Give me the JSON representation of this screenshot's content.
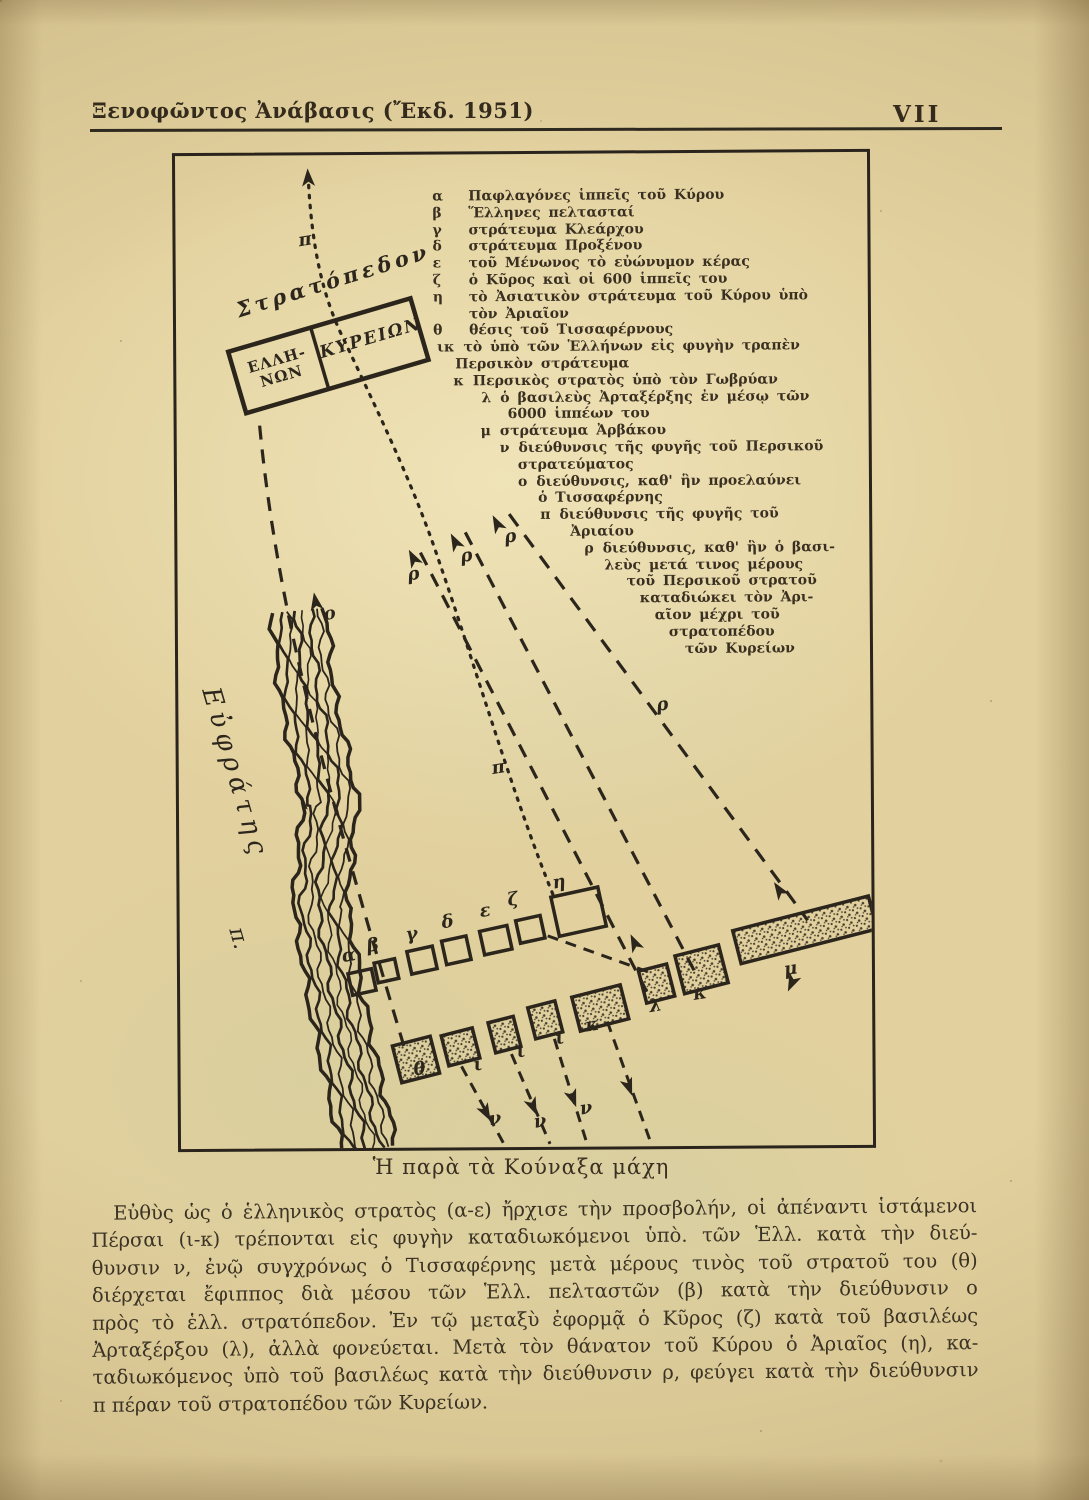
{
  "page": {
    "header": {
      "title": "Ξενοφῶντος Ἀνάβασις (Ἔκδ. 1951)",
      "page_number": "VII"
    },
    "caption": "Ἡ παρὰ τὰ Κούναξα μάχη",
    "body_lines": [
      "Εὐθὺς ὡς ὁ ἑλληνικὸς στρατὸς (α-ε) ἤρχισε τὴν προσβολήν, οἱ ἀπέναντι ἱστάμενοι",
      "Πέρσαι (ι-κ) τρέπονται εἰς φυγὴν καταδιωκόμενοι ὑπὸ. τῶν Ἑλλ. κατὰ τὴν διεύ-",
      "θυνσιν ν, ἐνῷ συγχρόνως ὁ Τισσαφέρνης μετὰ μέρους τινὸς τοῦ στρατοῦ του (θ)",
      "διέρχεται ἔφιππος διὰ μέσου τῶν Ἑλλ. πελταστῶν (β) κατὰ τὴν διεύθυνσιν ο",
      "πρὸς τὸ ἑλλ. στρατόπεδον. Ἐν τῷ μεταξὺ ἐφορμᾷ ὁ Κῦρος (ζ) κατὰ τοῦ βασιλέως",
      "Ἀρταξέρξου (λ), ἀλλὰ φονεύεται. Μετὰ τὸν θάνατον τοῦ Κύρου ὁ Ἀριαῖος (η), κα-",
      "ταδιωκόμενος ὑπὸ τοῦ βασιλέως κατὰ τὴν διεύθυνσιν ρ, φεύγει κατὰ τὴν διεύθυνσιν",
      "π πέραν τοῦ στρατοπέδου τῶν Κυρείων."
    ]
  },
  "legend": {
    "lines": [
      {
        "k": "α",
        "t": "Παφλαγόνες ἱππεῖς τοῦ Κύρου"
      },
      {
        "k": "β",
        "t": "Ἕλληνες πελτασταί"
      },
      {
        "k": "γ",
        "t": "στράτευμα Κλεάρχου"
      },
      {
        "k": "δ",
        "t": "στράτευμα Προξένου"
      },
      {
        "k": "ε",
        "t": "τοῦ Μένωνος τὸ εὐώνυμον κέρας"
      },
      {
        "k": "ζ",
        "t": "ὁ Κῦρος καὶ οἱ 600 ἱππεῖς του"
      },
      {
        "k": "η",
        "t": "τὸ Ἀσιατικὸν στράτευμα τοῦ Κύρου ὑπὸ"
      },
      {
        "k": "",
        "t": "τὸν Ἀριαῖον"
      },
      {
        "k": "θ",
        "t": "θέσις τοῦ Τισσαφέρνους"
      },
      {
        "k": "ικ",
        "t": "τὸ ὑπὸ τῶν Ἑλλήνων εἰς φυγὴν τραπὲν"
      },
      {
        "k": "",
        "t": "Περσικὸν στράτευμα"
      },
      {
        "k": "κ",
        "t": "Περσικὸς στρατὸς ὑπὸ τὸν Γωβρύαν"
      },
      {
        "k": "λ",
        "t": "ὁ βασιλεὺς Ἀρταξέρξης ἐν μέσῳ τῶν"
      },
      {
        "k": "",
        "t": "6000 ἱππέων του"
      },
      {
        "k": "μ",
        "t": "στράτευμα Ἀρβάκου"
      },
      {
        "k": "ν",
        "t": "διεύθυνσις τῆς φυγῆς τοῦ Περσικοῦ"
      },
      {
        "k": "",
        "t": "στρατεύματος"
      },
      {
        "k": "ο",
        "t": "διεύθυνσις, καθ' ἣν προελαύνει"
      },
      {
        "k": "",
        "t": "ὁ Τισσαφέρνης"
      },
      {
        "k": "π",
        "t": "διεύθυνσις τῆς φυγῆς τοῦ"
      },
      {
        "k": "",
        "t": "Ἀριαίου"
      },
      {
        "k": "ρ",
        "t": "διεύθυνσις, καθ' ἣν ὁ βασι-"
      },
      {
        "k": "",
        "t": "λεὺς μετά τινος μέρους"
      },
      {
        "k": "",
        "t": "τοῦ Περσικοῦ στρατοῦ"
      },
      {
        "k": "",
        "t": "καταδιώκει τὸν Ἀρι-"
      },
      {
        "k": "",
        "t": "αῖον μέχρι τοῦ"
      },
      {
        "k": "",
        "t": "στρατοπέδου"
      },
      {
        "k": "",
        "t": "τῶν Κυρείων"
      }
    ]
  },
  "map": {
    "camp": {
      "label_top": "Στρατόπεδον",
      "cell_left_line1": "ΕΛΛΗ-",
      "cell_left_line2": "ΝΩΝ",
      "cell_right": "ΚΥΡΕΙΩΝ"
    },
    "river": {
      "name": "Εὐφράτης",
      "suffix": "π."
    },
    "markers": [
      {
        "t": "α"
      },
      {
        "t": "β"
      },
      {
        "t": "γ"
      },
      {
        "t": "δ"
      },
      {
        "t": "ε"
      },
      {
        "t": "ζ"
      },
      {
        "t": "η"
      },
      {
        "t": "θ"
      },
      {
        "t": "ι"
      },
      {
        "t": "ι"
      },
      {
        "t": "ι"
      },
      {
        "t": "κ"
      },
      {
        "t": "λ"
      },
      {
        "t": "κ"
      },
      {
        "t": "μ"
      },
      {
        "t": "ο"
      },
      {
        "t": "ρ"
      },
      {
        "t": "ρ"
      },
      {
        "t": "ρ"
      },
      {
        "t": "ρ"
      },
      {
        "t": "π"
      },
      {
        "t": "π"
      },
      {
        "t": "ν"
      },
      {
        "t": "ν"
      },
      {
        "t": "ν"
      }
    ]
  },
  "colors": {
    "ink": "#2b251c",
    "paper": "#e2d19e"
  }
}
